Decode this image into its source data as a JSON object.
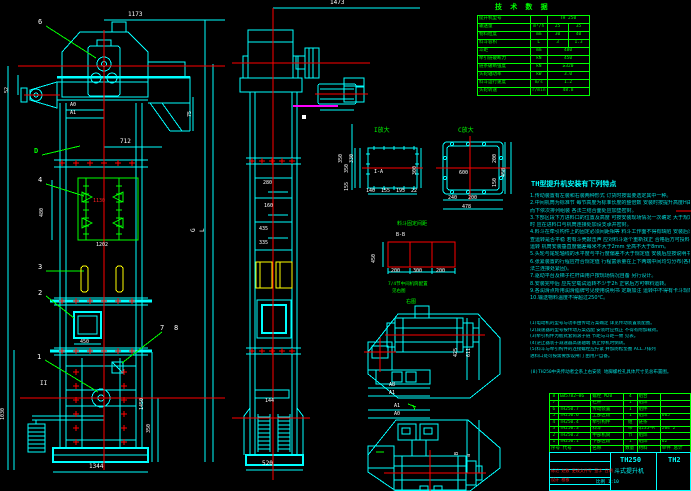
{
  "tech": {
    "title": "技 术 数 据",
    "rows": [
      {
        "label": "提升机型号",
        "unit": "",
        "v1": "TH 250",
        "v2": ""
      },
      {
        "label": "输送量",
        "unit": "m³/h",
        "v1": "25",
        "v2": "35"
      },
      {
        "label": "物料粒度",
        "unit": "mm",
        "v1": "30",
        "v2": "40"
      },
      {
        "label": "料斗容积",
        "unit": "L",
        "v1": "3",
        "v2": "1.3"
      },
      {
        "label": "斗距",
        "unit": "mm",
        "v1": "480",
        "v2": ""
      },
      {
        "label": "牵引链破断力",
        "unit": "kN",
        "v1": "450",
        "v2": ""
      },
      {
        "label": "链条破断强度",
        "unit": "kN",
        "v1": "≥320",
        "v2": ""
      },
      {
        "label": "头轮轴功率",
        "unit": "kW",
        "v1": "3.0",
        "v2": ""
      },
      {
        "label": "料斗运行速度",
        "unit": "m/s",
        "v1": "1.2",
        "v2": ""
      },
      {
        "label": "头轮转速",
        "unit": "r/min",
        "v1": "48.8",
        "v2": ""
      }
    ]
  },
  "notes": {
    "title": "TH型提升机安装有下列特点",
    "lines": [
      "1.传动装置有左装和右装两种形式 订货时按需要选定其中一种。",
      "2.中间机筒为标准节 每节高度为标准长度的整倍数 安装时按提升高度H由上",
      "  而下依次排列组装 各法兰结合面处应加垫密封。",
      "3.下部区段下方进料口的位置及高度 可按安装现场情况一次确定 大于规定值",
      "  时 应在进料口与机筒连接处加设支承并密封。",
      "4.料斗在牵引构件上的固定必须间距相等 料斗工作面不得有缺陷 安装后须检",
      "  查运转是否平稳 若有斗壳敲击声 应对料斗逐个重新找正 合格后方可投料",
      "  运转 机筒安装垂直度偏差每米不大于2mm 全高不大于8mm。",
      "5.头轮与尾轮轴线的水平度与平行度偏差不大于规定值 安装后应按说明书要求",
      "6.张紧装置的行程应符合规定值 行程富余量在上下两端中间均匀分布(各机筒",
      "  法兰连接处紧固)。",
      "7.驱动平台及梯子栏杆由用户按现场情况自备 另行设计。",
      "8.安装完毕后 应先空载试运转不少于2h 正常后方可带料运转。",
      "9.各润滑点所用润滑脂牌号见使用说明书 定期加注 运转中不得有卡斗现象。",
      "10.输送物料温度不得超过250℃。"
    ],
    "sub": [
      "(1)电动机的型号与功率由传动方案确定 详见传动装置装配图。",
      "(2)减速器的型号按传动方案选配 安装时应找正 不得有附加载荷。",
      "(3)牵引构件为板式套筒滚子链 节距与斗距一致 见表。",
      "(4)逆止器装于减速器高速轴端 防止停机时倒转。",
      "(5)料斗与牵引构件的连接螺栓应拧紧 并加防松垫圈 ACL.7排列",
      "  进料口处可按需要加设闸门 由用户自备。"
    ],
    "footer": "(8)TH250中央传动者全系上右安装 地脚螺栓孔具体尺寸见总布置图。"
  },
  "bom": {
    "rows": [
      {
        "no": "8",
        "code": "GB5782—86",
        "name": "螺栓 M20",
        "qty": "4",
        "mat": "组合",
        "note": ""
      },
      {
        "no": "7",
        "code": "",
        "name": "栏杆",
        "qty": "1",
        "mat": "组焊",
        "note": ""
      },
      {
        "no": "6",
        "code": "TH250.7",
        "name": "传动装置",
        "qty": "1",
        "mat": "组件",
        "note": ""
      },
      {
        "no": "5",
        "code": "TH250.6",
        "name": "上部区段",
        "qty": "1",
        "mat": "组焊",
        "note": "605"
      },
      {
        "no": "4",
        "code": "TH250.4",
        "name": "牵引构件",
        "qty": "组",
        "mat": "链条",
        "note": ""
      },
      {
        "no": "3",
        "code": "TH250.3",
        "name": "料斗",
        "qty": "带",
        "mat": "Q235—A",
        "note": "204 2"
      },
      {
        "no": "2",
        "code": "TH250.2",
        "name": "中部机筒",
        "qty": "节",
        "mat": "组焊",
        "note": ""
      },
      {
        "no": "1",
        "code": "TH250.1",
        "name": "下部区段",
        "qty": "1",
        "mat": "组焊",
        "note": "62"
      }
    ],
    "hdr": {
      "no": "序号 代号",
      "name": "名称",
      "qty": "数量",
      "mat": "材料",
      "note": "单件 总计"
    }
  },
  "tb": {
    "model": "TH250",
    "product": "斗式提升机",
    "dno": "TH2",
    "rev": "标记 处数 更改文件号 签字 日期",
    "sign": "设计 校核",
    "scale_label": "比例",
    "scale": "1:10"
  },
  "labels": {
    "b1": "1",
    "b2": "2",
    "b3": "3",
    "b4": "4",
    "b6": "6",
    "b7": "7",
    "b8": "8",
    "dmark": "D",
    "sectII": "II",
    "iTitle": "I放大",
    "iMark": "I-A",
    "cTitle": "C放大",
    "kTitle": "料斗固定间距",
    "kMark": "B-B",
    "cfg1": "7/4节中间机筒配置",
    "cfg2": "见右图",
    "rTitle": "右图"
  },
  "dims": {
    "d1173": "1173",
    "d52": "52",
    "dA0": "A0",
    "dA1": "A1",
    "d712": "712",
    "d75": "75",
    "d480": "480",
    "d1130": "1130",
    "d1202": "1202",
    "d450": "450",
    "d1030": "1030",
    "d1450": "1450",
    "d350L": "350",
    "d1344": "1344",
    "dG": "G",
    "dL": "L",
    "dH": "H(提升高度)",
    "d1473": "1473",
    "d280": "280",
    "d160": "160",
    "d435": "435",
    "d335": "335",
    "d144": "144",
    "d520": "520",
    "d350m": "350",
    "d330": "330",
    "i140": "140",
    "i155": "155",
    "i195": "195",
    "i22": "22",
    "i350": "350",
    "i155v": "155",
    "i300": "300",
    "c600": "600",
    "c240": "240",
    "c200": "200",
    "c478": "478",
    "c458": "458",
    "c200v": "200",
    "c150": "150",
    "k200a": "200",
    "k300": "300",
    "k200b": "200",
    "k450": "450",
    "aA8": "A8",
    "aA1": "A1",
    "a425": "425",
    "a611": "611",
    "bA1": "A1",
    "bA0": "A0",
    "bB": "B",
    "ba": "a"
  }
}
